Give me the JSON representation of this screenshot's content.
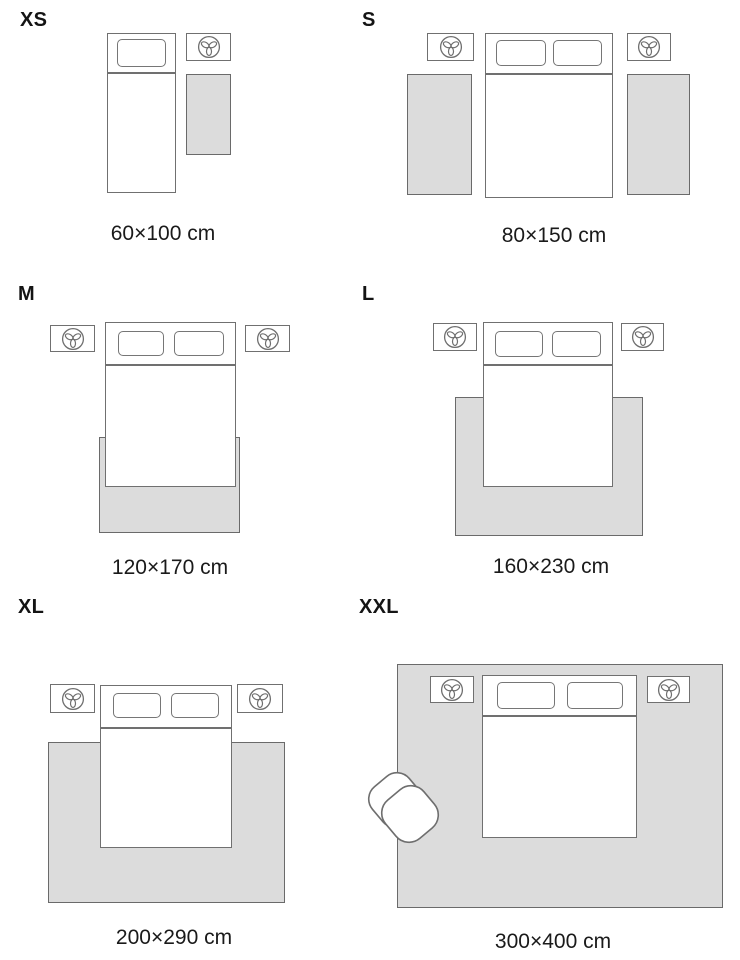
{
  "guide": {
    "sections": [
      {
        "id": "xs",
        "label": "XS",
        "dimensions": "60×100 cm"
      },
      {
        "id": "s",
        "label": "S",
        "dimensions": "80×150 cm"
      },
      {
        "id": "m",
        "label": "M",
        "dimensions": "120×170 cm"
      },
      {
        "id": "l",
        "label": "L",
        "dimensions": "160×230 cm"
      },
      {
        "id": "xl",
        "label": "XL",
        "dimensions": "200×290 cm"
      },
      {
        "id": "xxl",
        "label": "XXL",
        "dimensions": "300×400 cm"
      }
    ],
    "icons": {
      "nightstand": "plant-icon",
      "xxl_extra": "armchair-icon"
    },
    "colors": {
      "rug_fill": "#dcdcdc",
      "outline": "#707070",
      "text": "#1a1a1a",
      "background": "#ffffff"
    }
  }
}
